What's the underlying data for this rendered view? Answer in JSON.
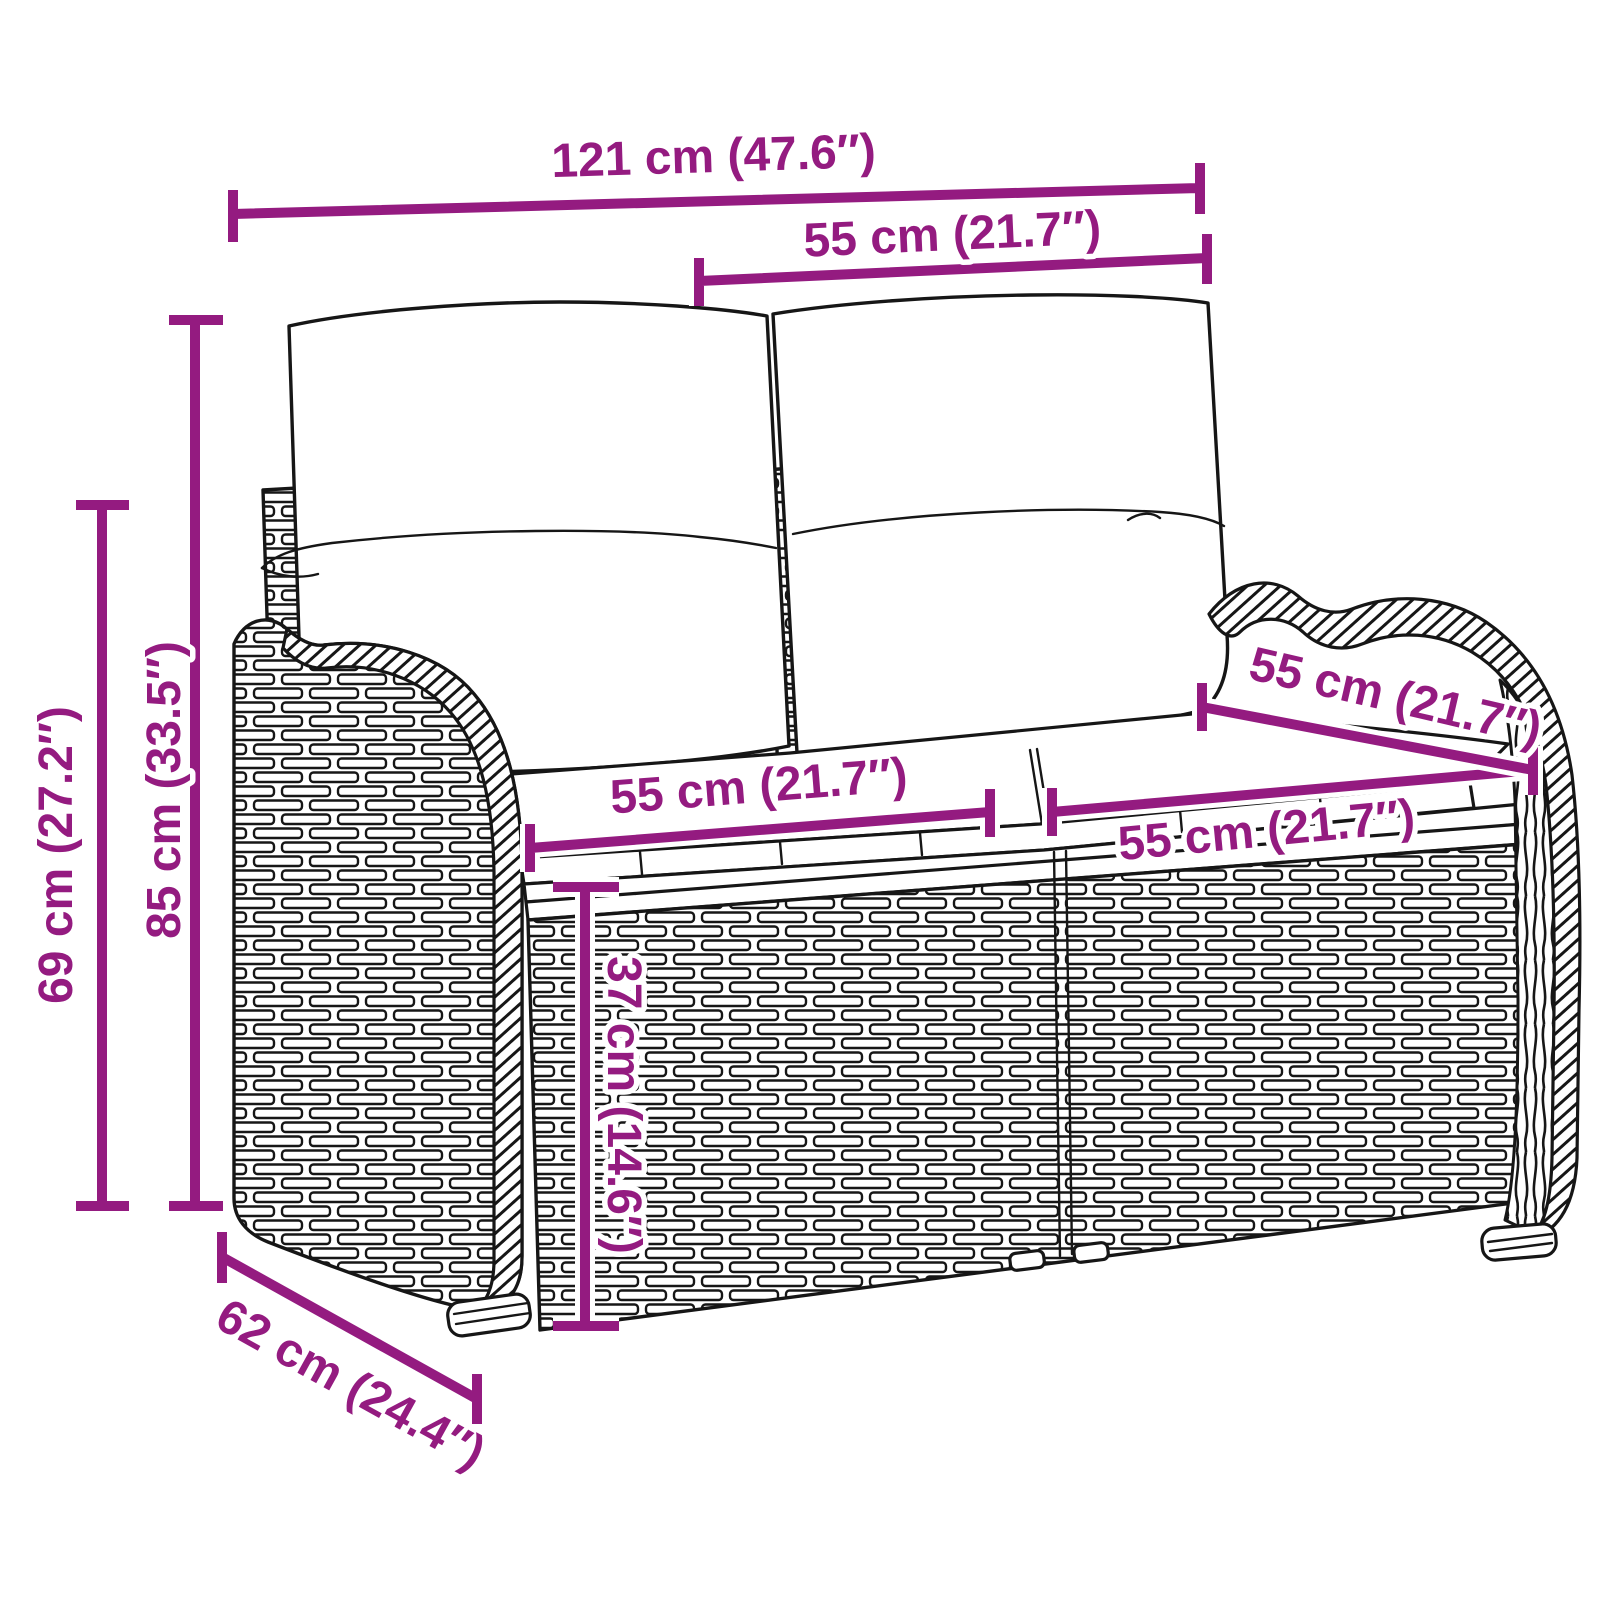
{
  "diagram": {
    "name": "garden-bench-dimension-diagram",
    "subject": "poly-rattan 2-seater garden bench with back and seat cushions",
    "background_color": "#ffffff",
    "line_color": "#161616",
    "accent_color": "#941b80",
    "labels": {
      "overall_width": "121 cm (47.6″)",
      "back_cushion_width": "55 cm (21.7″)",
      "total_height": "85 cm (33.5″)",
      "armrest_height": "69 cm (27.2″)",
      "seat_left_width": "55 cm (21.7″)",
      "seat_right_width": "55 cm (21.7″)",
      "seat_depth": "55 cm (21.7″)",
      "seat_height": "37 cm (14.6″)",
      "overall_depth": "62 cm (24.4″)"
    }
  }
}
